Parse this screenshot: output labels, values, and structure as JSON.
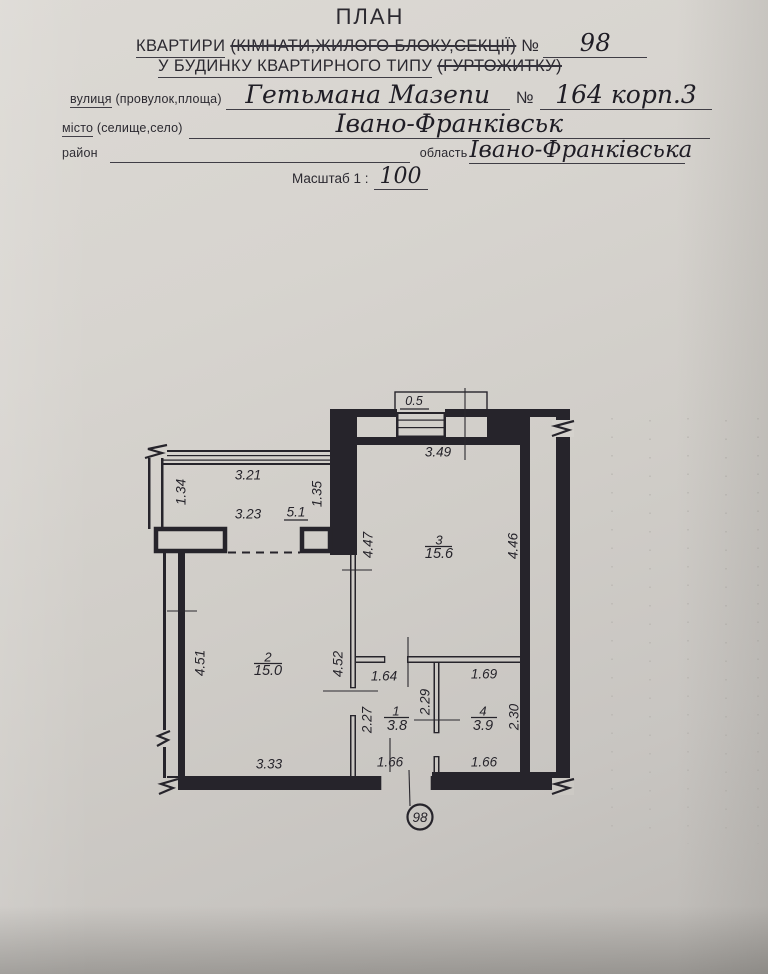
{
  "header": {
    "title": "ПЛАН",
    "line_apartment": {
      "prefix": "КВАРТИРИ",
      "struck": "(КІМНАТИ,ЖИЛОГО БЛОКУ,СЕКЦІЇ)",
      "no_sign": "№",
      "number": "98"
    },
    "line_building": {
      "underlined": "У БУДИНКУ КВАРТИРНОГО ТИПУ",
      "struck": "(ГУРТОЖИТКУ)"
    },
    "street": {
      "label_word": "вулиця",
      "label_rest": "(провулок,площа)",
      "value": "Гетьмана Мазепи",
      "no_sign": "№",
      "building": "164 корп.3"
    },
    "city": {
      "label_word": "місто",
      "label_rest": "(селище,село)",
      "value": "Івано-Франківськ"
    },
    "district": {
      "label": "район"
    },
    "region": {
      "label": "область",
      "value": "Івано-Франківська"
    },
    "scale": {
      "label": "Масштаб 1 :",
      "value": "100"
    }
  },
  "plan": {
    "apartment_badge": "98",
    "rooms": [
      {
        "number": "1",
        "area": "3.8"
      },
      {
        "number": "2",
        "area": "15.0"
      },
      {
        "number": "3",
        "area": "15.6"
      },
      {
        "number": "4",
        "area": "3.9"
      }
    ],
    "dims": {
      "niche_width": "0.5",
      "window_wall": "3.49",
      "balcony_top": "3.21",
      "balcony_bottom": "3.23",
      "balcony_area": "5.1",
      "balcony_left": "1.34",
      "balcony_right": "1.35",
      "room3_left": "4.47",
      "room3_right": "4.46",
      "room2_left": "4.51",
      "room2_right": "4.52",
      "room2_bottom": "3.33",
      "hall_top": "1.64",
      "hall_left": "2.27",
      "hall_divider": "2.29",
      "hall_bottom": "1.66",
      "bath_top": "1.69",
      "bath_right": "2.30",
      "bath_bottom": "1.66"
    }
  }
}
